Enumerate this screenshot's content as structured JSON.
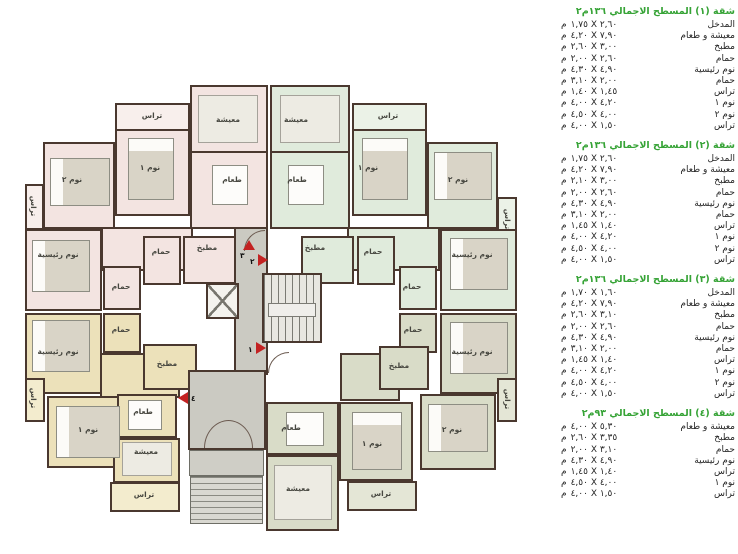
{
  "unit": "م",
  "colors": {
    "accent_green": "#36a336",
    "marker_red": "#c32222",
    "apt1_pink": "#f3e4e1",
    "apt2_green": "#e0ebdc",
    "apt3_sage": "#d9dcc8",
    "apt4_yellow": "#ece1ba",
    "core_gray": "#cbcac2",
    "wall": "#4a382f"
  },
  "plan": {
    "room_labels": {
      "living": "معيشة",
      "dining": "طعام",
      "kitchen": "مطبخ",
      "bath": "حمام",
      "bed1": "نوم ١",
      "bed2": "نوم ٢",
      "master": "نوم رئيسية",
      "terrace": "تراس"
    },
    "markers": {
      "m1": "١",
      "m2": "٢",
      "m3": "٣",
      "m4": "٤"
    }
  },
  "apartments": [
    {
      "title": "شقة (١) المسطح الاجمالي ١٣٦م٢",
      "rows": [
        {
          "name": "المدخل",
          "dims": "١,٧٥ X ٢,٦٠"
        },
        {
          "name": "معيشة و طعام",
          "dims": "٤,٢٠ X ٧,٩٠"
        },
        {
          "name": "مطبخ",
          "dims": "٢,٦٠ X ٣,٠٠"
        },
        {
          "name": "حمام",
          "dims": "٢,٠٠ X ٢,٦٠"
        },
        {
          "name": "نوم رئيسية",
          "dims": "٤,٣٠ X ٤,٩٠"
        },
        {
          "name": "حمام",
          "dims": "٣,١٠ X ٢,٠٠"
        },
        {
          "name": "تراس",
          "dims": "١,٤٠ X ١,٤٥"
        },
        {
          "name": "نوم ١",
          "dims": "٤,٠٠ X ٤,٢٠"
        },
        {
          "name": "نوم ٢",
          "dims": "٤,٥٠ X ٤,٠٠"
        },
        {
          "name": "تراس",
          "dims": "٤,٠٠ X ١,٥٠"
        }
      ]
    },
    {
      "title": "شقة (٢) المسطح الاجمالي ١٣٦م٢",
      "rows": [
        {
          "name": "المدخل",
          "dims": "١,٧٥ X ٢,٦٠"
        },
        {
          "name": "معيشة و طعام",
          "dims": "٤,٢٠ X ٧,٩٠"
        },
        {
          "name": "مطبخ",
          "dims": "٢,١٠ X ٣,٠٠"
        },
        {
          "name": "حمام",
          "dims": "٢,٠٠ X ٢,٦٠"
        },
        {
          "name": "نوم رئيسية",
          "dims": "٤,٣٠ X ٤,٩٠"
        },
        {
          "name": "حمام",
          "dims": "٣,١٠ X ٢,٠٠"
        },
        {
          "name": "تراس",
          "dims": "١,٤٥ X ١,٤٠"
        },
        {
          "name": "نوم ١",
          "dims": "٤,٠٠ X ٤,٢٠"
        },
        {
          "name": "نوم ٢",
          "dims": "٤,٥٠ X ٤,٠٠"
        },
        {
          "name": "تراس",
          "dims": "٤,٠٠ X ١,٥٠"
        }
      ]
    },
    {
      "title": "شقة (٣) المسطح الاجمالي ١٣٦م٢",
      "rows": [
        {
          "name": "المدخل",
          "dims": "١,٧٠ X ١,٦٠"
        },
        {
          "name": "معيشة و طعام",
          "dims": "٤,٢٠ X ٧,٩٠"
        },
        {
          "name": "مطبخ",
          "dims": "٢,٦٠ X ٣,١٠"
        },
        {
          "name": "حمام",
          "dims": "٢,٠٠ X ٢,٦٠"
        },
        {
          "name": "نوم رئيسية",
          "dims": "٤,٣٠ X ٤,٩٠"
        },
        {
          "name": "حمام",
          "dims": "٣,١٠ X ٢,٠٠"
        },
        {
          "name": "تراس",
          "dims": "١,٤٥ X ١,٤٠"
        },
        {
          "name": "نوم ١",
          "dims": "٤,٠٠ X ٤,٢٠"
        },
        {
          "name": "نوم ٢",
          "dims": "٤,٥٠ X ٤,٠٠"
        },
        {
          "name": "تراس",
          "dims": "٤,٠٠ X ١,٥٠"
        }
      ]
    },
    {
      "title": "شقة (٤) المسطح الاجمالي ٩٣م٢",
      "rows": [
        {
          "name": "معيشة و طعام",
          "dims": "٤,٠٠ X ٥,٣٠"
        },
        {
          "name": "مطبخ",
          "dims": "٢,٦٠ X ٣,٣٥"
        },
        {
          "name": "حمام",
          "dims": "٢,٠٠ X ٣,١٠"
        },
        {
          "name": "نوم رئيسية",
          "dims": "٤,٣٠ X ٤,٩٠"
        },
        {
          "name": "تراس",
          "dims": "١,٤٥ X ١,٤٠"
        },
        {
          "name": "نوم ١",
          "dims": "٤,٥٠ X ٤,٠٠"
        },
        {
          "name": "تراس",
          "dims": "٤,٠٠ X ١,٥٠"
        }
      ]
    }
  ]
}
